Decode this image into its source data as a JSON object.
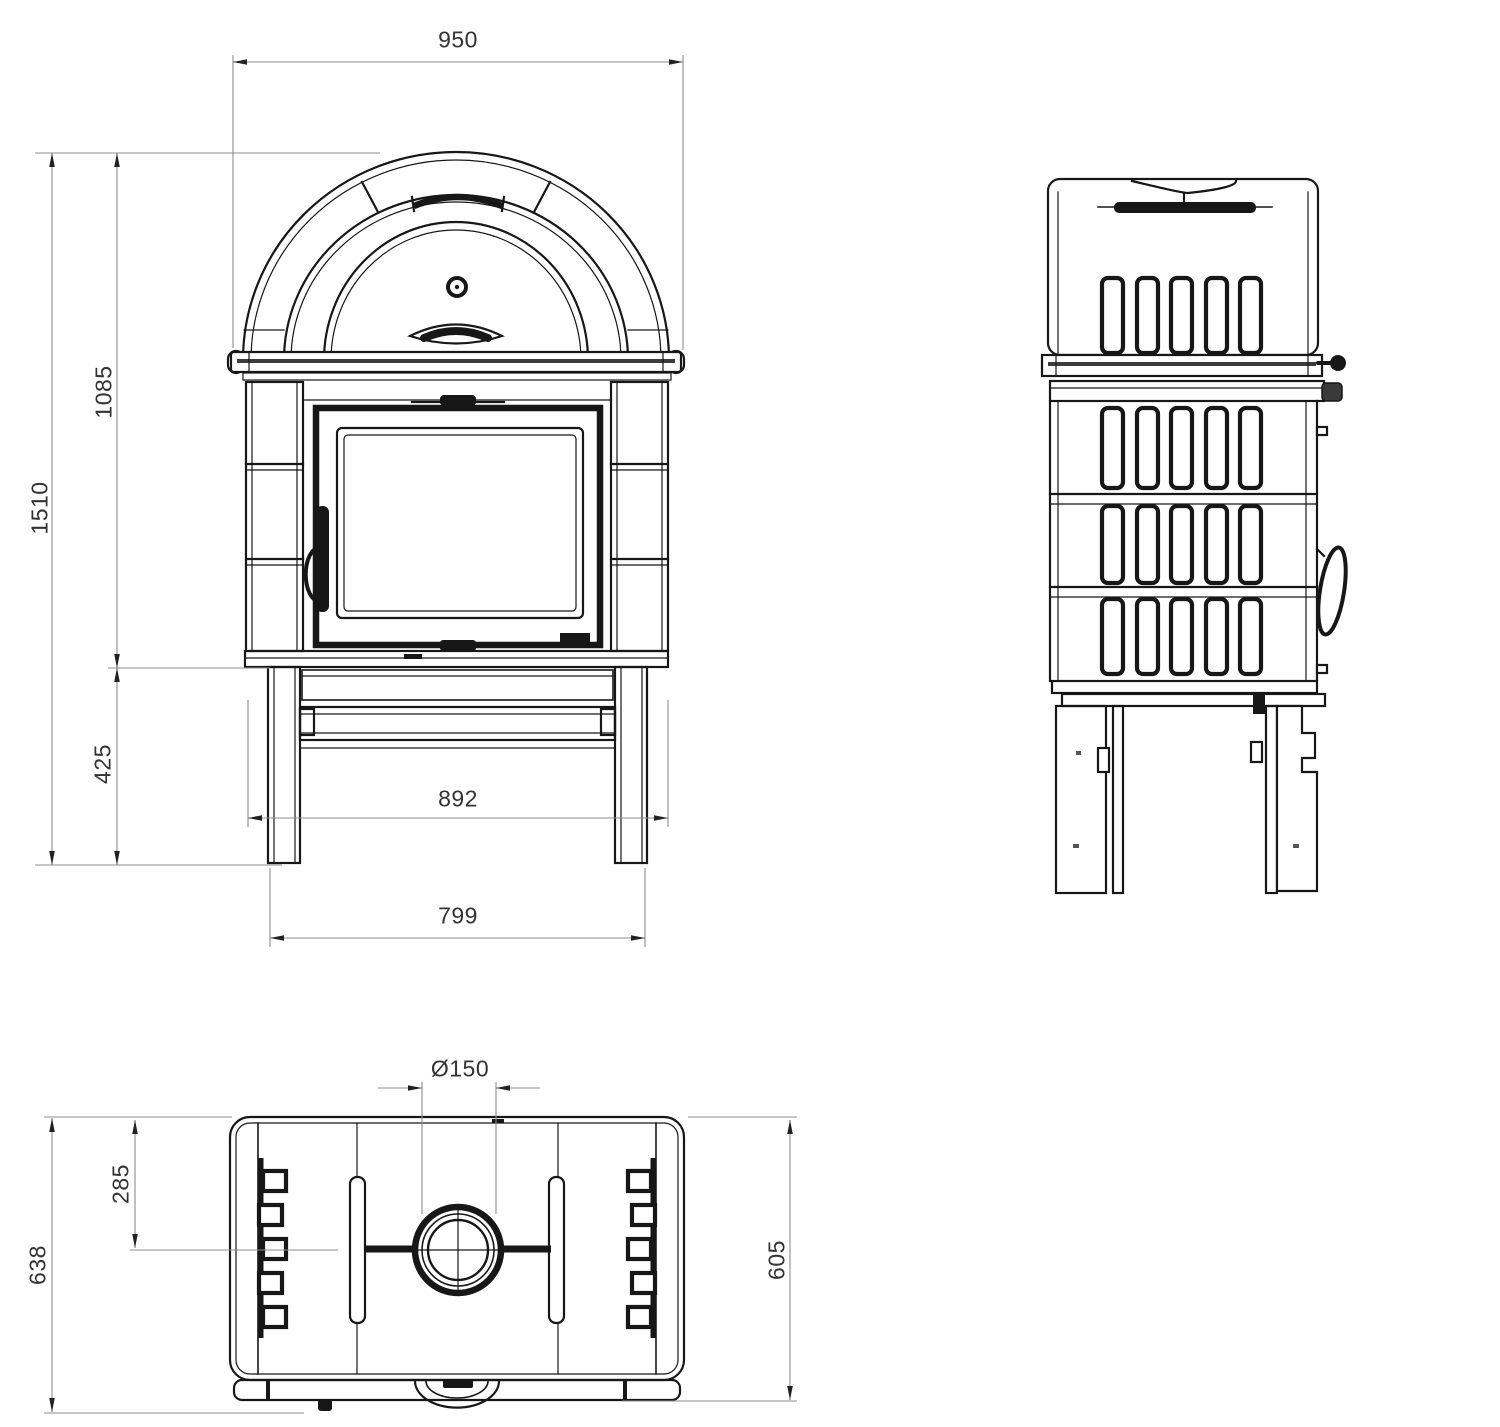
{
  "colors": {
    "background": "#ffffff",
    "object_line": "#171717",
    "dimension_line": "#8c8c8c",
    "label_text": "#333333"
  },
  "dimensions": {
    "front_view": {
      "total_width": "950",
      "total_height": "1510",
      "body_height": "1085",
      "base_height": "425",
      "base_width": "892",
      "leg_span": "799"
    },
    "top_view": {
      "flue_diameter": "Ø150",
      "flue_center_offset": "285",
      "total_depth": "638",
      "body_depth": "605"
    }
  }
}
